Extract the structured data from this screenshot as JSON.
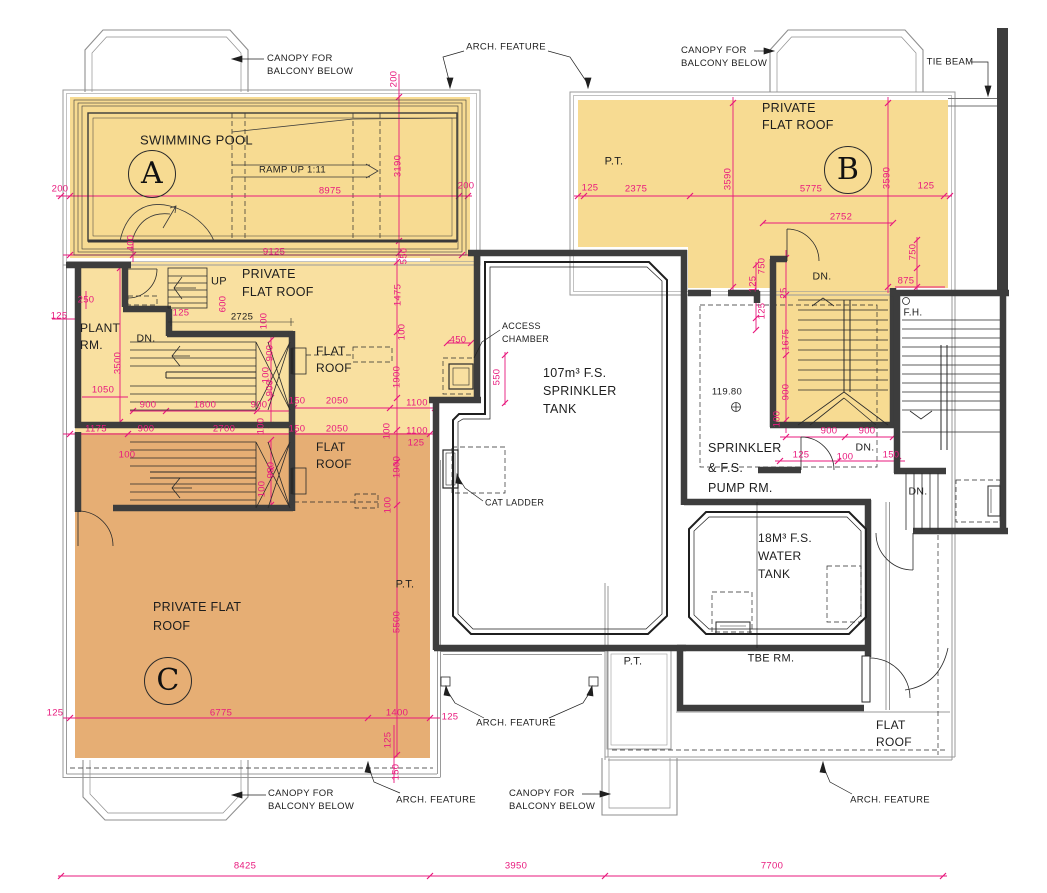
{
  "drawing_type": "roof floor plan",
  "palette": {
    "flat_roof_yellow": "#f7db92",
    "flat_roof_orange": "#e6ae74",
    "wall_dark": "#3d3d3d",
    "dimension_pink": "#e8197d",
    "outline_gray": "#9a9a9a",
    "line_black": "#1f1f1f"
  },
  "annotations": {
    "letters": [
      {
        "n": "block-a-label",
        "t": "A",
        "x": 152,
        "y": 174
      },
      {
        "n": "block-b-label",
        "t": "B",
        "x": 848,
        "y": 170
      },
      {
        "n": "block-c-label",
        "t": "C",
        "x": 168,
        "y": 681
      }
    ],
    "notes": [
      {
        "n": "canopy-note-top-left",
        "t": "CANOPY FOR\nBALCONY BELOW",
        "x": 267,
        "y": 65,
        "s": 9.5,
        "a": "l"
      },
      {
        "n": "arch-feature-note-top",
        "t": "ARCH. FEATURE",
        "x": 506,
        "y": 47,
        "s": 9.5
      },
      {
        "n": "canopy-note-top-right",
        "t": "CANOPY FOR\nBALCONY BELOW",
        "x": 681,
        "y": 57,
        "s": 9.5,
        "a": "l"
      },
      {
        "n": "tie-beam-note",
        "t": "TIE BEAM",
        "x": 950,
        "y": 62,
        "s": 9.5
      },
      {
        "n": "swimming-pool-label",
        "t": "SWIMMING POOL",
        "x": 140,
        "y": 140,
        "s": 13,
        "a": "l"
      },
      {
        "n": "ramp-note",
        "t": "RAMP UP 1:11",
        "x": 259,
        "y": 170,
        "s": 9.5,
        "a": "l"
      },
      {
        "n": "private-flat-roof-label-b",
        "t": "PRIVATE\nFLAT ROOF",
        "x": 762,
        "y": 117,
        "s": 12.5,
        "a": "l",
        "lh": 17
      },
      {
        "n": "pt-label-b",
        "t": "P.T.",
        "x": 614,
        "y": 162,
        "s": 11
      },
      {
        "n": "up-label",
        "t": "UP",
        "x": 219,
        "y": 282,
        "s": 11
      },
      {
        "n": "private-flat-roof-label-mid",
        "t": "PRIVATE\nFLAT ROOF",
        "x": 242,
        "y": 283,
        "s": 12.5,
        "a": "l",
        "lh": 18
      },
      {
        "n": "plant-rm-label",
        "t": "PLANT\nRM.",
        "x": 80,
        "y": 337,
        "s": 12,
        "a": "l",
        "lh": 17
      },
      {
        "n": "dn-label-mid",
        "t": "DN.",
        "x": 146,
        "y": 339,
        "s": 10.5
      },
      {
        "n": "flat-roof-label-yellow",
        "t": "FLAT\nROOF",
        "x": 316,
        "y": 360,
        "s": 12,
        "a": "l",
        "lh": 17
      },
      {
        "n": "access-chamber-note",
        "t": "ACCESS\nCHAMBER",
        "x": 502,
        "y": 333,
        "s": 9,
        "a": "l"
      },
      {
        "n": "tank-107-label",
        "t": "107m³ F.S.\nSPRINKLER\nTANK",
        "x": 543,
        "y": 391,
        "s": 12.5,
        "a": "l",
        "lh": 18
      },
      {
        "n": "cat-ladder-note",
        "t": "CAT LADDER",
        "x": 485,
        "y": 503,
        "s": 9,
        "a": "l"
      },
      {
        "n": "dn-label-b",
        "t": "DN.",
        "x": 822,
        "y": 277,
        "s": 10.5
      },
      {
        "n": "fh-label",
        "t": "F.H.",
        "x": 913,
        "y": 313,
        "s": 10
      },
      {
        "n": "pump-rm-label",
        "t": "SPRINKLER\n& F.S.\nPUMP RM.",
        "x": 708,
        "y": 468,
        "s": 12.5,
        "a": "l",
        "lh": 20
      },
      {
        "n": "level-value",
        "t": "119.80",
        "x": 727,
        "y": 392,
        "s": 9.5
      },
      {
        "n": "dn-label-stair-mid",
        "t": "DN.",
        "x": 865,
        "y": 448,
        "s": 10.5
      },
      {
        "n": "dn-label-right",
        "t": "DN.",
        "x": 918,
        "y": 492,
        "s": 10.5
      },
      {
        "n": "tank-18-label",
        "t": "18M³ F.S.\nWATER\nTANK",
        "x": 758,
        "y": 556,
        "s": 12,
        "a": "l",
        "lh": 18
      },
      {
        "n": "tbe-rm-label",
        "t": "TBE RM.",
        "x": 771,
        "y": 659,
        "s": 11
      },
      {
        "n": "flat-roof-label-orange",
        "t": "FLAT\nROOF",
        "x": 316,
        "y": 456,
        "s": 12,
        "a": "l",
        "lh": 17
      },
      {
        "n": "private-flat-roof-label-c",
        "t": "PRIVATE FLAT\nROOF",
        "x": 153,
        "y": 617,
        "s": 12.5,
        "a": "l",
        "lh": 19
      },
      {
        "n": "pt-label-c",
        "t": "P.T.",
        "x": 405,
        "y": 585,
        "s": 11
      },
      {
        "n": "pt-label-bottom",
        "t": "P.T.",
        "x": 633,
        "y": 662,
        "s": 11
      },
      {
        "n": "arch-feature-note-mid",
        "t": "ARCH. FEATURE",
        "x": 516,
        "y": 723,
        "s": 9.5
      },
      {
        "n": "flat-roof-label-br",
        "t": "FLAT\nROOF",
        "x": 876,
        "y": 734,
        "s": 12,
        "a": "l",
        "lh": 17
      },
      {
        "n": "canopy-note-bottom-left",
        "t": "CANOPY FOR\nBALCONY BELOW",
        "x": 268,
        "y": 800,
        "s": 9.5,
        "a": "l"
      },
      {
        "n": "arch-feature-note-bl",
        "t": "ARCH. FEATURE",
        "x": 436,
        "y": 800,
        "s": 9.5
      },
      {
        "n": "canopy-note-bottom-center",
        "t": "CANOPY FOR\nBALCONY BELOW",
        "x": 509,
        "y": 800,
        "s": 9.5,
        "a": "l"
      },
      {
        "n": "arch-feature-note-br",
        "t": "ARCH. FEATURE",
        "x": 890,
        "y": 800,
        "s": 9.5
      },
      {
        "n": "dim-2725-black",
        "t": "2725",
        "x": 242,
        "y": 317,
        "s": 9.5
      }
    ],
    "dims": [
      {
        "t": "200",
        "x": 60,
        "y": 189
      },
      {
        "t": "8975",
        "x": 330,
        "y": 191
      },
      {
        "t": "200",
        "x": 466,
        "y": 186
      },
      {
        "t": "3190",
        "x": 398,
        "y": 166,
        "r": 1
      },
      {
        "t": "200",
        "x": 394,
        "y": 79,
        "r": 1
      },
      {
        "t": "9125",
        "x": 274,
        "y": 252
      },
      {
        "t": "400",
        "x": 131,
        "y": 243,
        "r": 1
      },
      {
        "t": "550",
        "x": 404,
        "y": 256,
        "r": 1
      },
      {
        "t": "125",
        "x": 590,
        "y": 188
      },
      {
        "t": "2375",
        "x": 636,
        "y": 189
      },
      {
        "t": "5775",
        "x": 811,
        "y": 189
      },
      {
        "t": "125",
        "x": 926,
        "y": 186
      },
      {
        "t": "3590",
        "x": 728,
        "y": 179,
        "r": 1
      },
      {
        "t": "3590",
        "x": 887,
        "y": 178,
        "r": 1
      },
      {
        "t": "2752",
        "x": 841,
        "y": 217
      },
      {
        "t": "750",
        "x": 762,
        "y": 266,
        "r": 1
      },
      {
        "t": "750",
        "x": 913,
        "y": 252,
        "r": 1
      },
      {
        "t": "875",
        "x": 906,
        "y": 281
      },
      {
        "t": "125",
        "x": 753,
        "y": 284,
        "r": 1
      },
      {
        "t": "25",
        "x": 784,
        "y": 293,
        "r": 1
      },
      {
        "t": "125",
        "x": 762,
        "y": 311,
        "r": 1
      },
      {
        "t": "1675",
        "x": 786,
        "y": 340,
        "r": 1
      },
      {
        "t": "900",
        "x": 786,
        "y": 392,
        "r": 1
      },
      {
        "t": "100",
        "x": 777,
        "y": 419,
        "r": 1
      },
      {
        "t": "900",
        "x": 829,
        "y": 431
      },
      {
        "t": "900",
        "x": 867,
        "y": 431
      },
      {
        "t": "125",
        "x": 801,
        "y": 455
      },
      {
        "t": "100",
        "x": 845,
        "y": 457
      },
      {
        "t": "150",
        "x": 891,
        "y": 455
      },
      {
        "t": "250",
        "x": 86,
        "y": 300
      },
      {
        "t": "125",
        "x": 59,
        "y": 316
      },
      {
        "t": "125",
        "x": 181,
        "y": 313
      },
      {
        "t": "600",
        "x": 223,
        "y": 304,
        "r": 1
      },
      {
        "t": "100",
        "x": 264,
        "y": 321,
        "r": 1
      },
      {
        "t": "3500",
        "x": 118,
        "y": 363,
        "r": 1
      },
      {
        "t": "1050",
        "x": 103,
        "y": 390
      },
      {
        "t": "900",
        "x": 270,
        "y": 353,
        "r": 1
      },
      {
        "t": "100",
        "x": 266,
        "y": 375,
        "r": 1
      },
      {
        "t": "900",
        "x": 270,
        "y": 388,
        "r": 1
      },
      {
        "t": "900",
        "x": 148,
        "y": 405
      },
      {
        "t": "1800",
        "x": 205,
        "y": 405
      },
      {
        "t": "900",
        "x": 259,
        "y": 405
      },
      {
        "t": "150",
        "x": 297,
        "y": 401
      },
      {
        "t": "2050",
        "x": 337,
        "y": 401
      },
      {
        "t": "1100",
        "x": 417,
        "y": 403
      },
      {
        "t": "1475",
        "x": 398,
        "y": 295,
        "r": 1
      },
      {
        "t": "100",
        "x": 402,
        "y": 332,
        "r": 1
      },
      {
        "t": "1900",
        "x": 397,
        "y": 377,
        "r": 1
      },
      {
        "t": "450",
        "x": 458,
        "y": 340
      },
      {
        "t": "550",
        "x": 497,
        "y": 377,
        "r": 1
      },
      {
        "t": "1175",
        "x": 96,
        "y": 429
      },
      {
        "t": "900",
        "x": 146,
        "y": 429
      },
      {
        "t": "2700",
        "x": 224,
        "y": 429
      },
      {
        "t": "100",
        "x": 261,
        "y": 426,
        "r": 1
      },
      {
        "t": "150",
        "x": 297,
        "y": 429
      },
      {
        "t": "2050",
        "x": 337,
        "y": 429
      },
      {
        "t": "100",
        "x": 387,
        "y": 431,
        "r": 1
      },
      {
        "t": "1100",
        "x": 417,
        "y": 431
      },
      {
        "t": "125",
        "x": 416,
        "y": 443
      },
      {
        "t": "100",
        "x": 127,
        "y": 455
      },
      {
        "t": "900",
        "x": 271,
        "y": 470,
        "r": 1
      },
      {
        "t": "100",
        "x": 262,
        "y": 489,
        "r": 1
      },
      {
        "t": "1900",
        "x": 397,
        "y": 467,
        "r": 1
      },
      {
        "t": "100",
        "x": 388,
        "y": 505,
        "r": 1
      },
      {
        "t": "5500",
        "x": 397,
        "y": 622,
        "r": 1
      },
      {
        "t": "125",
        "x": 55,
        "y": 713
      },
      {
        "t": "6775",
        "x": 221,
        "y": 713
      },
      {
        "t": "1400",
        "x": 397,
        "y": 713
      },
      {
        "t": "125",
        "x": 388,
        "y": 740,
        "r": 1
      },
      {
        "t": "150",
        "x": 396,
        "y": 772,
        "r": 1
      },
      {
        "t": "125",
        "x": 450,
        "y": 717
      },
      {
        "t": "8425",
        "x": 245,
        "y": 866
      },
      {
        "t": "3950",
        "x": 516,
        "y": 866
      },
      {
        "t": "7700",
        "x": 772,
        "y": 866
      }
    ]
  }
}
